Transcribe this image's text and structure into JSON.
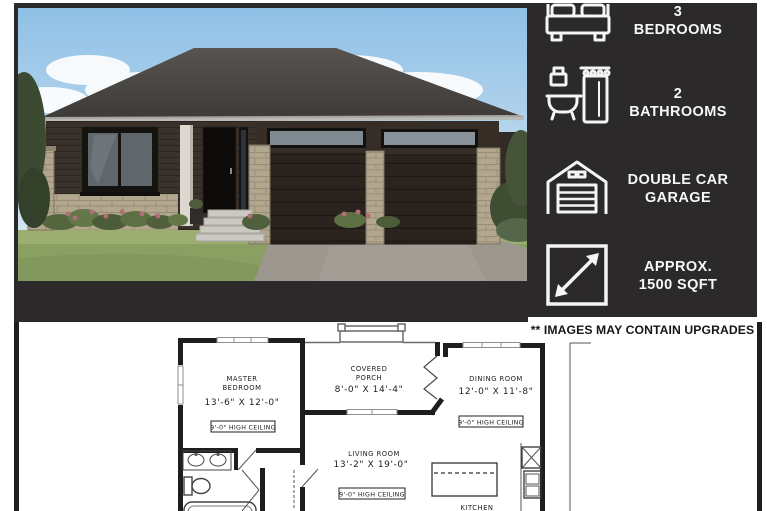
{
  "colors": {
    "panel_bg": "#2b2929",
    "text_light": "#f7f7f7",
    "plan_ink": "#1f1d1d"
  },
  "specs": [
    {
      "icon": "bed-icon",
      "value": "3",
      "label": "BEDROOMS"
    },
    {
      "icon": "bathtub-icon",
      "value": "2",
      "label": "BATHROOMS"
    },
    {
      "icon": "garage-icon",
      "value": "DOUBLE CAR",
      "label": "GARAGE"
    },
    {
      "icon": "dimensions-icon",
      "value": "APPROX.",
      "label": "1500 SQFT"
    }
  ],
  "disclaimer": "** IMAGES MAY CONTAIN UPGRADES",
  "floorplan": {
    "master": {
      "name_line1": "MASTER",
      "name_line2": "BEDROOM",
      "dims": "13'-6\" X 12'-0\"",
      "ceiling": "9'-0\" HIGH CEILING"
    },
    "porch": {
      "name_line1": "COVERED",
      "name_line2": "PORCH",
      "dims": "8'-0\" X 14'-4\""
    },
    "dining": {
      "name": "DINING ROOM",
      "dims": "12'-0\" X 11'-8\"",
      "ceiling": "9'-0\" HIGH CEILING"
    },
    "living": {
      "name": "LIVING ROOM",
      "dims": "13'-2\" X 19'-0\"",
      "ceiling": "9'-0\" HIGH CEILING"
    },
    "kitchen": {
      "name": "KITCHEN"
    }
  }
}
